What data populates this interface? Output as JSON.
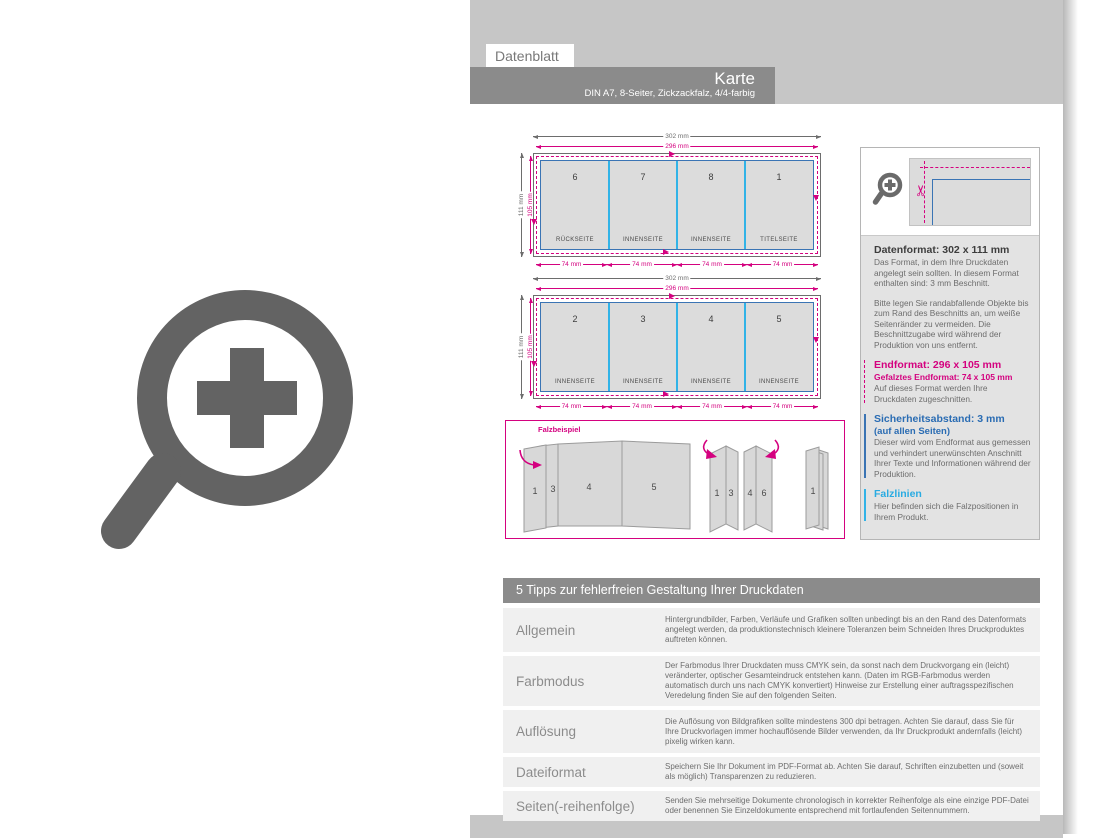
{
  "header": {
    "tab": "Datenblatt",
    "title": "Karte",
    "subtitle": "DIN A7, 8-Seiter, Zickzackfalz, 4/4-farbig"
  },
  "dims": {
    "outer_w": "302 mm",
    "inner_w": "296 mm",
    "outer_h": "111 mm",
    "inner_h": "105 mm",
    "panel_w": "74 mm"
  },
  "sheets": [
    {
      "panels": [
        {
          "num": "6",
          "label": "RÜCKSEITE"
        },
        {
          "num": "7",
          "label": "INNENSEITE"
        },
        {
          "num": "8",
          "label": "INNENSEITE"
        },
        {
          "num": "1",
          "label": "TITELSEITE"
        }
      ]
    },
    {
      "panels": [
        {
          "num": "2",
          "label": "INNENSEITE"
        },
        {
          "num": "3",
          "label": "INNENSEITE"
        },
        {
          "num": "4",
          "label": "INNENSEITE"
        },
        {
          "num": "5",
          "label": "INNENSEITE"
        }
      ]
    }
  ],
  "fold": {
    "label": "Falzbeispiel",
    "s1": [
      "1",
      "3",
      "4",
      "5"
    ],
    "s2": [
      "1",
      "3",
      "4",
      "6"
    ],
    "s3": [
      "1"
    ]
  },
  "info": {
    "datenformat_title": "Datenformat: 302 x 111 mm",
    "datenformat_body": "Das Format, in dem Ihre Druckdaten angelegt sein sollten. In diesem Format enthalten sind: 3 mm Beschnitt.",
    "bleed_note": "Bitte legen Sie randabfallende Objekte bis zum Rand des Beschnitts an, um weiße Seitenränder zu vermeiden. Die Beschnittzugabe wird während der Produktion von uns entfernt.",
    "endformat_title": "Endformat: 296 x 105 mm",
    "endformat_sub": "Gefalztes Endformat: 74 x 105 mm",
    "endformat_body": "Auf dieses Format werden Ihre Druckdaten zugeschnitten.",
    "safety_title": "Sicherheitsabstand: 3 mm",
    "safety_sub": "(auf allen Seiten)",
    "safety_body": "Dieser wird vom Endformat aus gemessen und verhindert unerwünschten Anschnitt Ihrer Texte und Informationen während der Produktion.",
    "falz_title": "Falzlinien",
    "falz_body": "Hier befinden sich die Falzpositionen in Ihrem Produkt."
  },
  "tips": {
    "header": "5 Tipps zur fehlerfreien Gestaltung Ihrer Druckdaten",
    "rows": [
      {
        "label": "Allgemein",
        "text": "Hintergrundbilder, Farben, Verläufe und Grafiken sollten unbedingt bis an den Rand des Datenformats angelegt werden, da produktionstechnisch kleinere Toleranzen beim Schneiden Ihres Druckproduktes auftreten können."
      },
      {
        "label": "Farbmodus",
        "text": "Der Farbmodus Ihrer Druckdaten muss CMYK sein, da sonst nach dem Druckvorgang ein (leicht) veränderter, optischer Gesamteindruck entstehen kann. (Daten im RGB-Farbmodus werden automatisch durch uns nach CMYK konvertiert) Hinweise zur Erstellung einer auftragsspezifischen Veredelung finden Sie auf den folgenden Seiten."
      },
      {
        "label": "Auflösung",
        "text": "Die Auflösung von Bildgrafiken sollte mindestens 300 dpi betragen. Achten Sie darauf, dass Sie für Ihre Druckvorlagen immer hochauflösende Bilder verwenden, da Ihr Druckprodukt andernfalls (leicht) pixelig wirken kann."
      },
      {
        "label": "Dateiformat",
        "text": "Speichern Sie Ihr Dokument im PDF-Format ab. Achten Sie darauf, Schriften einzubetten und (soweit als möglich) Transparenzen zu reduzieren."
      },
      {
        "label": "Seiten(-reihenfolge)",
        "text": "Senden Sie mehrseitige Dokumente chronologisch in korrekter Reihenfolge als eine einzige PDF-Datei oder benennen Sie Einzeldokumente entsprechend mit fortlaufenden Seitennummern."
      }
    ]
  },
  "icons": {
    "zoom_in_large": "magnifier-with-plus",
    "zoom_in_small": "magnifier-with-plus",
    "scissors": "✂",
    "cut_mark": "arrow-mark"
  },
  "colors": {
    "magenta": "#d4017f",
    "cyan": "#31b3e7",
    "blue": "#3a74b4",
    "band_gray": "#c6c6c6",
    "bar_gray": "#8b8b8b",
    "icon_gray": "#636363"
  }
}
